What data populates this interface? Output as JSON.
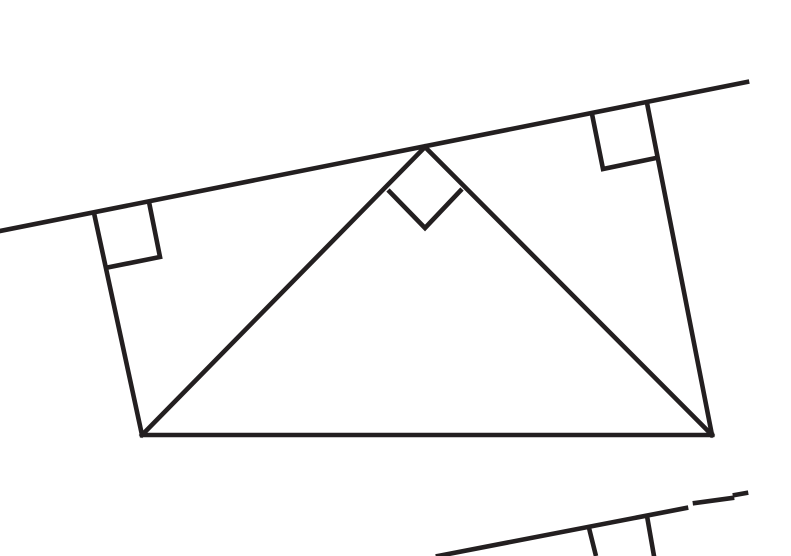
{
  "canvas": {
    "width": 791,
    "height": 556,
    "background": "#ffffff",
    "stroke_color": "#231f20",
    "stroke_width": 4.6
  },
  "figures": [
    {
      "name": "main-figure",
      "lines": [
        {
          "name": "transversal-line",
          "points": [
            [
              0,
              231
            ],
            [
              747,
              82
            ]
          ]
        },
        {
          "name": "quad-left-side",
          "points": [
            [
              94,
              213
            ],
            [
              142,
              435
            ]
          ]
        },
        {
          "name": "quad-right-side",
          "points": [
            [
              647,
              103
            ],
            [
              712,
              435
            ]
          ]
        },
        {
          "name": "quad-bottom-side",
          "points": [
            [
              142,
              435
            ],
            [
              712,
              435
            ]
          ]
        },
        {
          "name": "left-cevian",
          "points": [
            [
              425,
              147
            ],
            [
              142,
              435
            ]
          ]
        },
        {
          "name": "right-cevian",
          "points": [
            [
              425,
              147
            ],
            [
              712,
              435
            ]
          ]
        },
        {
          "name": "right-angle-mark-left",
          "points": [
            [
              149,
              202
            ],
            [
              160,
              257
            ],
            [
              105,
              268
            ]
          ]
        },
        {
          "name": "right-angle-mark-top-right",
          "points": [
            [
              592,
              114
            ],
            [
              603,
              169
            ],
            [
              656,
              158
            ]
          ]
        },
        {
          "name": "right-angle-mark-apex",
          "points": [
            [
              388,
              190
            ],
            [
              425,
              228
            ],
            [
              462,
              189
            ]
          ]
        }
      ]
    },
    {
      "name": "partial-figure-bottom-right",
      "lines": [
        {
          "name": "transversal2-segment-1",
          "points": [
            [
              438,
              556
            ],
            [
              686,
              508
            ]
          ]
        },
        {
          "name": "transversal2-segment-2",
          "points": [
            [
              695,
              503
            ],
            [
              732,
              498
            ]
          ]
        },
        {
          "name": "transversal2-end-dash",
          "points": [
            [
              735,
              495
            ],
            [
              746,
              493
            ]
          ]
        },
        {
          "name": "right-angle-mark-edge-2",
          "points": [
            [
              589,
              528
            ],
            [
              596,
              556
            ]
          ]
        },
        {
          "name": "perpendicular-side-2",
          "points": [
            [
              647,
              516
            ],
            [
              654,
              556
            ]
          ]
        }
      ]
    }
  ]
}
